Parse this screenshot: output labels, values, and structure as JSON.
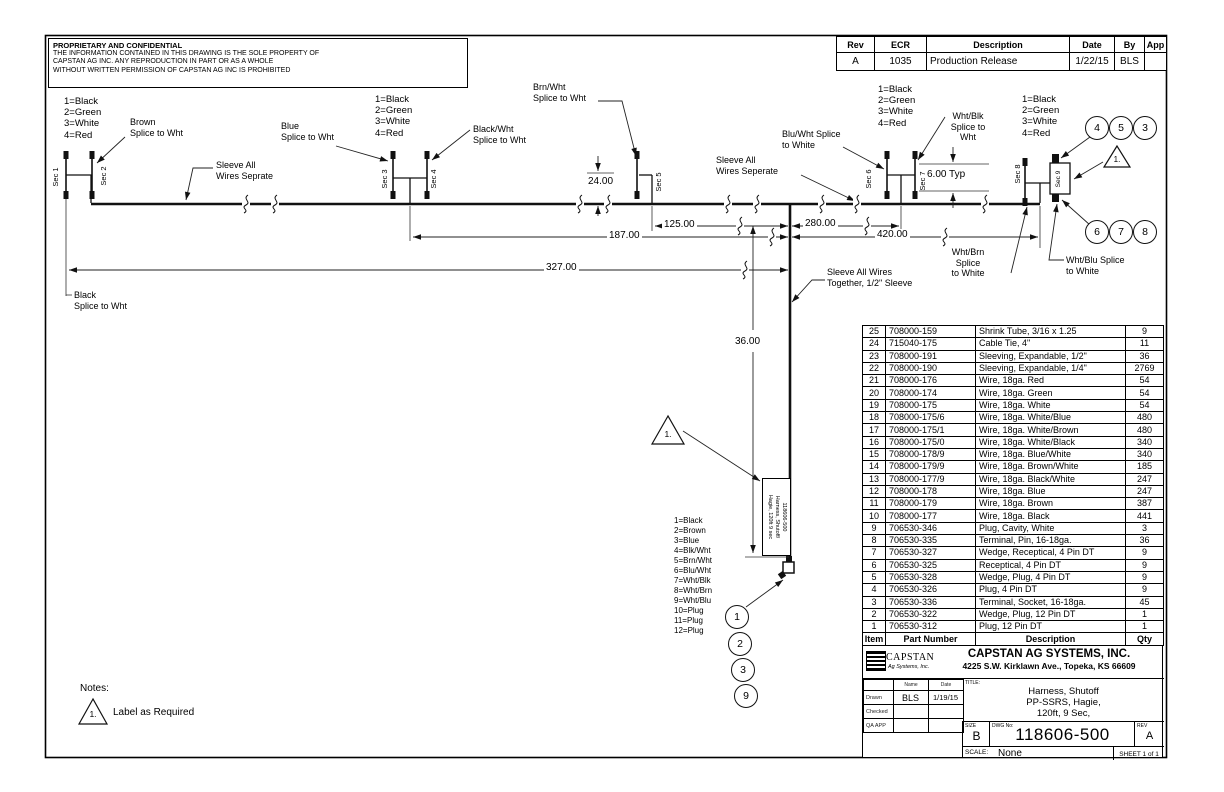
{
  "proprietary": {
    "title": "PROPRIETARY AND CONFIDENTIAL",
    "body": "THE INFORMATION CONTAINED IN THIS DRAWING IS THE SOLE PROPERTY OF\nCAPSTAN AG INC. ANY REPRODUCTION IN PART OR AS A WHOLE\nWITHOUT WRITTEN PERMISSION OF CAPSTAN AG INC IS PROHIBITED"
  },
  "revision_table": {
    "headers": [
      "Rev",
      "ECR",
      "Description",
      "Date",
      "By",
      "App"
    ],
    "row": [
      "A",
      "1035",
      "Production Release",
      "1/22/15",
      "BLS",
      ""
    ]
  },
  "schematic": {
    "connector_legend": [
      "1=Black",
      "2=Green",
      "3=White",
      "4=Red"
    ],
    "pin_legend": [
      "1=Black",
      "2=Brown",
      "3=Blue",
      "4=Blk/Wht",
      "5=Brn/Wht",
      "6=Blu/Wht",
      "7=Wht/Blk",
      "8=Wht/Brn",
      "9=Wht/Blu",
      "10=Plug",
      "11=Plug",
      "12=Plug"
    ],
    "sections": [
      "Sec 1",
      "Sec 2",
      "Sec 3",
      "Sec 4",
      "Sec 5",
      "Sec 6",
      "Sec 7",
      "Sec 8",
      "Sec 9"
    ],
    "splices": {
      "brown": "Brown\nSplice to Wht",
      "blue": "Blue\nSplice to Wht",
      "black_wht": "Black/Wht\nSplice to Wht",
      "brn_wht": "Brn/Wht\nSplice to Wht",
      "blu_wht": "Blu/Wht Splice\nto White",
      "wht_blk": "Wht/Blk\nSplice to\nWht",
      "wht_brn": "Wht/Brn\nSplice\nto White",
      "wht_blu": "Wht/Blu Splice\nto White",
      "black": "Black\nSplice to Wht"
    },
    "sleeves": {
      "separate_left": "Sleeve All\nWires Seprate",
      "separate_right": "Sleeve All\nWires Seperate",
      "together": "Sleeve All Wires\nTogether, 1/2\" Sleeve"
    },
    "dimensions": {
      "d24": "24.00",
      "d6": "6.00 Typ",
      "d125": "125.00",
      "d187": "187.00",
      "d280": "280.00",
      "d420": "420.00",
      "d327": "327.00",
      "d36": "36.00"
    },
    "balloons_top": [
      "4",
      "5",
      "3"
    ],
    "balloons_right": [
      "6",
      "7",
      "8"
    ],
    "balloons_bottom": [
      "1",
      "2",
      "3",
      "9"
    ],
    "flag": "1.",
    "harness_tag": "118606-500\nHarness, Shutoff/\nHagie, 120ft 9 sec"
  },
  "notes": {
    "heading": "Notes:",
    "flag": "1.",
    "note1": "Label as Required"
  },
  "parts_table": {
    "headers": [
      "Item",
      "Part Number",
      "Description",
      "Qty"
    ],
    "rows": [
      [
        "25",
        "708000-159",
        "Shrink Tube, 3/16 x 1.25",
        "9"
      ],
      [
        "24",
        "715040-175",
        "Cable Tie, 4\"",
        "11"
      ],
      [
        "23",
        "708000-191",
        "Sleeving, Expandable, 1/2\"",
        "36"
      ],
      [
        "22",
        "708000-190",
        "Sleeving, Expandable, 1/4\"",
        "2769"
      ],
      [
        "21",
        "708000-176",
        "Wire, 18ga. Red",
        "54"
      ],
      [
        "20",
        "708000-174",
        "Wire, 18ga. Green",
        "54"
      ],
      [
        "19",
        "708000-175",
        "Wire, 18ga. White",
        "54"
      ],
      [
        "18",
        "708000-175/6",
        "Wire, 18ga. White/Blue",
        "480"
      ],
      [
        "17",
        "708000-175/1",
        "Wire, 18ga. White/Brown",
        "480"
      ],
      [
        "16",
        "708000-175/0",
        "Wire, 18ga. White/Black",
        "340"
      ],
      [
        "15",
        "708000-178/9",
        "Wire, 18ga. Blue/White",
        "340"
      ],
      [
        "14",
        "708000-179/9",
        "Wire, 18ga. Brown/White",
        "185"
      ],
      [
        "13",
        "708000-177/9",
        "Wire, 18ga. Black/White",
        "247"
      ],
      [
        "12",
        "708000-178",
        "Wire, 18ga. Blue",
        "247"
      ],
      [
        "11",
        "708000-179",
        "Wire, 18ga. Brown",
        "387"
      ],
      [
        "10",
        "708000-177",
        "Wire, 18ga. Black",
        "441"
      ],
      [
        "9",
        "706530-346",
        "Plug, Cavity, White",
        "3"
      ],
      [
        "8",
        "706530-335",
        "Terminal, Pin, 16-18ga.",
        "36"
      ],
      [
        "7",
        "706530-327",
        "Wedge, Receptical, 4 Pin DT",
        "9"
      ],
      [
        "6",
        "706530-325",
        "Receptical, 4 Pin DT",
        "9"
      ],
      [
        "5",
        "706530-328",
        "Wedge, Plug, 4 Pin DT",
        "9"
      ],
      [
        "4",
        "706530-326",
        "Plug, 4 Pin DT",
        "9"
      ],
      [
        "3",
        "706530-336",
        "Terminal, Socket, 16-18ga.",
        "45"
      ],
      [
        "2",
        "706530-322",
        "Wedge, Plug, 12 Pin DT",
        "1"
      ],
      [
        "1",
        "706530-312",
        "Plug, 12 Pin DT",
        "1"
      ]
    ]
  },
  "title_block": {
    "logo_name": "CAPSTAN",
    "logo_sub": "Ag Systems, Inc.",
    "company": "CAPSTAN AG SYSTEMS, INC.",
    "address": "4225 S.W. Kirklawn Ave., Topeka, KS 66609",
    "col_name": "Name",
    "col_date": "Date",
    "rows": [
      {
        "label": "Drawn",
        "name": "BLS",
        "date": "1/19/15"
      },
      {
        "label": "Checked",
        "name": "",
        "date": ""
      },
      {
        "label": "QA APP",
        "name": "",
        "date": ""
      }
    ],
    "title_label": "TITLE:",
    "title": "Harness, Shutoff\nPP-SSRS, Hagie,\n120ft, 9 Sec,",
    "size_label": "SIZE",
    "size": "B",
    "dwg_label": "DWG No:",
    "dwg_no": "118606-500",
    "rev_label": "REV",
    "rev": "A",
    "scale_label": "SCALE:",
    "scale": "None",
    "sheet": "SHEET 1 of 1"
  }
}
